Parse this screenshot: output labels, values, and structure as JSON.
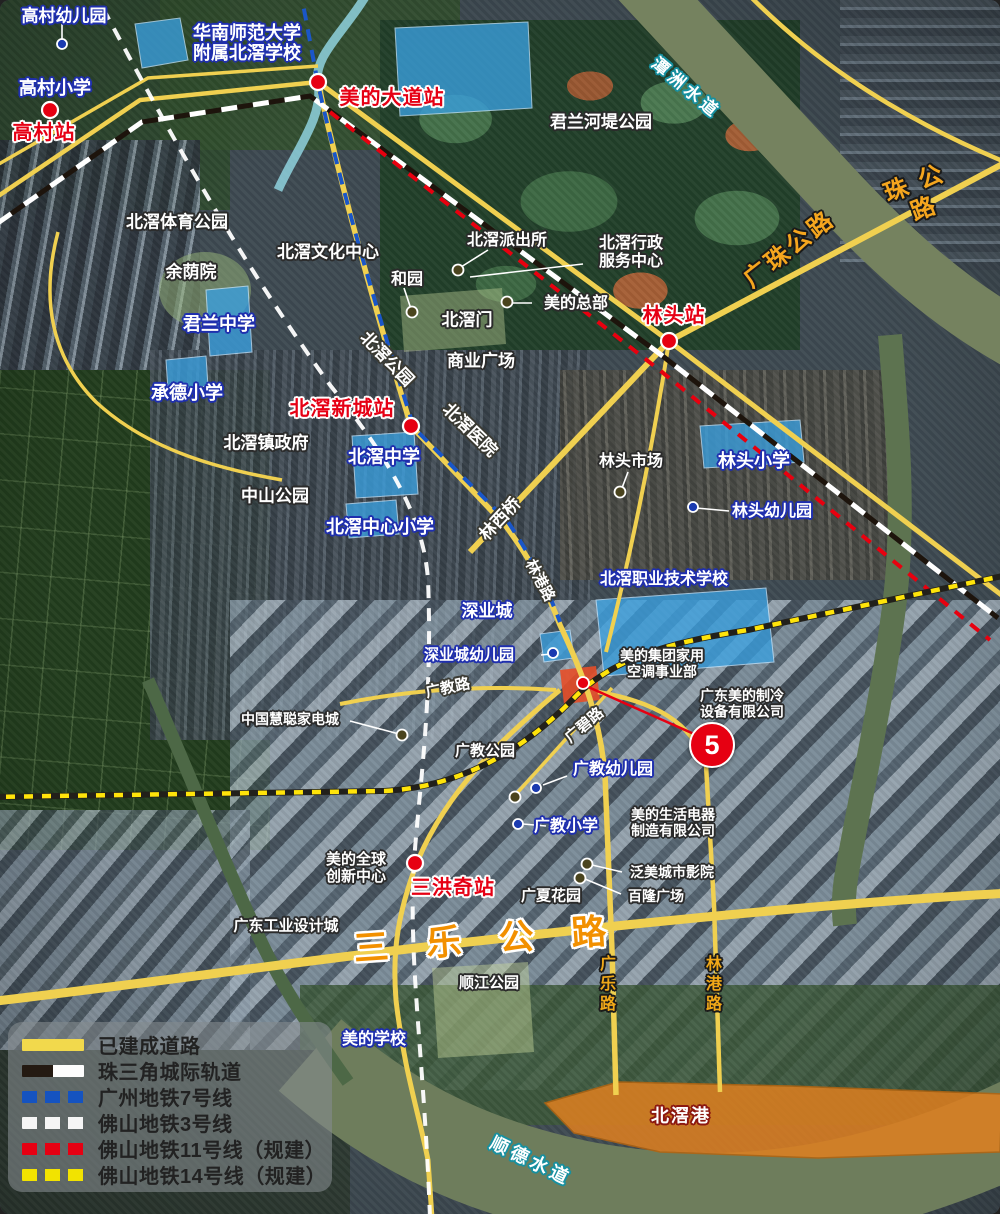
{
  "map": {
    "title": "北滘 卫星配套地图",
    "marker5": {
      "label": "5"
    },
    "colors": {
      "station_text": "#e60014",
      "school_outline": "#1f2fae",
      "road_yellow": "#f0d050",
      "highway_label": "#f29000",
      "metro7_blue": "#1553c0",
      "metro3_white": "#f5f5f5",
      "metro11_red": "#e60012",
      "metro14_yellow": "#f2e300",
      "port_fill": "#e08020",
      "school_fill": "#3aa0e0",
      "water_label_outline": "#1790a0"
    },
    "labels": [
      {
        "n": "label-gaocun-kindergarten",
        "t": "高村幼儿园",
        "c": "sc",
        "x": 64,
        "y": 16,
        "r": 0,
        "s": 17
      },
      {
        "n": "label-gaocun-primary",
        "t": "高村小学",
        "c": "sc",
        "x": 55,
        "y": 88,
        "r": 0,
        "s": 18
      },
      {
        "n": "label-scnu-beijiao-school",
        "t": "华南师范大学\n附属北滘学校",
        "c": "sc",
        "x": 247,
        "y": 43,
        "r": 0,
        "s": 18
      },
      {
        "n": "label-junlan-middle",
        "t": "君兰中学",
        "c": "sc",
        "x": 219,
        "y": 324,
        "r": 0,
        "s": 18
      },
      {
        "n": "label-chengde-primary",
        "t": "承德小学",
        "c": "sc",
        "x": 187,
        "y": 393,
        "r": 0,
        "s": 18
      },
      {
        "n": "label-beijiao-middle",
        "t": "北滘中学",
        "c": "sc",
        "x": 384,
        "y": 457,
        "r": 0,
        "s": 18
      },
      {
        "n": "label-beijiao-central-primary",
        "t": "北滘中心小学",
        "c": "sc",
        "x": 380,
        "y": 527,
        "r": 0,
        "s": 18
      },
      {
        "n": "label-lintou-primary",
        "t": "林头小学",
        "c": "sc",
        "x": 754,
        "y": 461,
        "r": 0,
        "s": 18
      },
      {
        "n": "label-lintou-kindergarten",
        "t": "林头幼儿园",
        "c": "sc",
        "x": 772,
        "y": 512,
        "r": 0,
        "s": 16
      },
      {
        "n": "label-beijiao-vocational",
        "t": "北滘职业技术学校",
        "c": "sc",
        "x": 664,
        "y": 580,
        "r": 0,
        "s": 16
      },
      {
        "n": "label-shenyecheng",
        "t": "深业城",
        "c": "sc",
        "x": 487,
        "y": 611,
        "r": 0,
        "s": 17
      },
      {
        "n": "label-shenyecheng-kindergarten",
        "t": "深业城幼儿园",
        "c": "sc",
        "x": 469,
        "y": 656,
        "r": 0,
        "s": 15
      },
      {
        "n": "label-guangjiao-kindergarten",
        "t": "广教幼儿园",
        "c": "sc",
        "x": 613,
        "y": 770,
        "r": 0,
        "s": 16
      },
      {
        "n": "label-guangjiao-primary",
        "t": "广教小学",
        "c": "sc",
        "x": 566,
        "y": 827,
        "r": 0,
        "s": 16
      },
      {
        "n": "label-midea-school",
        "t": "美的学校",
        "c": "sc",
        "x": 374,
        "y": 1040,
        "r": 0,
        "s": 16
      },
      {
        "n": "label-junlan-riverside-park",
        "t": "君兰河堤公园",
        "c": "pl",
        "x": 601,
        "y": 122,
        "r": 0,
        "s": 17
      },
      {
        "n": "label-beijiao-sports-park",
        "t": "北滘体育公园",
        "c": "pl",
        "x": 177,
        "y": 222,
        "r": 0,
        "s": 17
      },
      {
        "n": "label-yuyinyuan",
        "t": "余荫院",
        "c": "pl",
        "x": 191,
        "y": 272,
        "r": 0,
        "s": 17
      },
      {
        "n": "label-beijiao-culture-center",
        "t": "北滘文化中心",
        "c": "pl",
        "x": 328,
        "y": 252,
        "r": 0,
        "s": 17
      },
      {
        "n": "label-heyuan",
        "t": "和园",
        "c": "pl",
        "x": 407,
        "y": 280,
        "r": 0,
        "s": 16
      },
      {
        "n": "label-beijiao-police",
        "t": "北滘派出所",
        "c": "pl",
        "x": 507,
        "y": 241,
        "r": 0,
        "s": 16
      },
      {
        "n": "label-beijiao-admin-center",
        "t": "北滘行政\n服务中心",
        "c": "pl",
        "x": 631,
        "y": 253,
        "r": 0,
        "s": 16
      },
      {
        "n": "label-midea-hq",
        "t": "美的总部",
        "c": "pl",
        "x": 576,
        "y": 304,
        "r": 0,
        "s": 16
      },
      {
        "n": "label-beijiao-gate",
        "t": "北滘门",
        "c": "pl",
        "x": 467,
        "y": 320,
        "r": 0,
        "s": 17
      },
      {
        "n": "label-commercial-plaza",
        "t": "商业广场",
        "c": "pl",
        "x": 481,
        "y": 361,
        "r": 0,
        "s": 17
      },
      {
        "n": "label-beijiao-government",
        "t": "北滘镇政府",
        "c": "pl",
        "x": 266,
        "y": 443,
        "r": 0,
        "s": 17
      },
      {
        "n": "label-zhongshan-park",
        "t": "中山公园",
        "c": "pl",
        "x": 275,
        "y": 496,
        "r": 0,
        "s": 17
      },
      {
        "n": "label-lintou-market",
        "t": "林头市场",
        "c": "pl",
        "x": 631,
        "y": 462,
        "r": 0,
        "s": 16
      },
      {
        "n": "label-midea-hvac",
        "t": "美的集团家用\n空调事业部",
        "c": "pl",
        "x": 662,
        "y": 664,
        "r": 0,
        "s": 14
      },
      {
        "n": "label-gd-midea-refrigeration",
        "t": "广东美的制冷\n设备有限公司",
        "c": "pl",
        "x": 742,
        "y": 704,
        "r": 0,
        "s": 14
      },
      {
        "n": "label-hc360-mall",
        "t": "中国慧聪家电城",
        "c": "pl",
        "x": 290,
        "y": 720,
        "r": 0,
        "s": 14
      },
      {
        "n": "label-guangjiao-park",
        "t": "广教公园",
        "c": "pl",
        "x": 485,
        "y": 752,
        "r": 0,
        "s": 15
      },
      {
        "n": "label-midea-life-appliance",
        "t": "美的生活电器\n制造有限公司",
        "c": "pl",
        "x": 673,
        "y": 823,
        "r": 0,
        "s": 14
      },
      {
        "n": "label-panmei-cinema",
        "t": "泛美城市影院",
        "c": "pl",
        "x": 672,
        "y": 873,
        "r": 0,
        "s": 14
      },
      {
        "n": "label-bailong-plaza",
        "t": "百隆广场",
        "c": "pl",
        "x": 656,
        "y": 897,
        "r": 0,
        "s": 14
      },
      {
        "n": "label-guangxia-garden",
        "t": "广夏花园",
        "c": "pl",
        "x": 551,
        "y": 897,
        "r": 0,
        "s": 15
      },
      {
        "n": "label-midea-innovation-center",
        "t": "美的全球\n创新中心",
        "c": "pl",
        "x": 356,
        "y": 869,
        "r": 0,
        "s": 15
      },
      {
        "n": "label-gd-industrial-design-city",
        "t": "广东工业设计城",
        "c": "pl",
        "x": 286,
        "y": 927,
        "r": 0,
        "s": 15
      },
      {
        "n": "label-shunjiang-park",
        "t": "顺江公园",
        "c": "pl",
        "x": 489,
        "y": 984,
        "r": 0,
        "s": 15
      },
      {
        "n": "label-gaocun-station",
        "t": "高村站",
        "c": "st",
        "x": 44,
        "y": 133,
        "r": 0,
        "s": 20
      },
      {
        "n": "label-meide-avenue-station",
        "t": "美的大道站",
        "c": "st",
        "x": 392,
        "y": 98,
        "r": 0,
        "s": 20
      },
      {
        "n": "label-lintou-station",
        "t": "林头站",
        "c": "st",
        "x": 674,
        "y": 316,
        "r": 0,
        "s": 20
      },
      {
        "n": "label-beijiao-xincheng-station",
        "t": "北滘新城站",
        "c": "st",
        "x": 342,
        "y": 409,
        "r": 0,
        "s": 20
      },
      {
        "n": "label-sanhongqi-station",
        "t": "三洪奇站",
        "c": "st",
        "x": 453,
        "y": 888,
        "r": 0,
        "s": 20
      },
      {
        "n": "label-guangzhu-highway",
        "t": "广珠公路",
        "c": "ro",
        "x": 790,
        "y": 250,
        "r": -38,
        "s": 24
      },
      {
        "n": "label-guangzhu-highway-2",
        "t": "珠 公 路",
        "c": "ro",
        "x": 920,
        "y": 197,
        "r": -21,
        "s": 24
      },
      {
        "n": "label-sanle-highway",
        "t": "三 乐 公 路",
        "c": "rb",
        "x": 487,
        "y": 940,
        "r": -4,
        "s": 35
      },
      {
        "n": "label-beijiao-park-road",
        "t": "北滘公园",
        "c": "rw",
        "x": 387,
        "y": 359,
        "r": 46,
        "s": 17
      },
      {
        "n": "label-beijiao-hospital",
        "t": "北滘医院",
        "c": "rw",
        "x": 470,
        "y": 430,
        "r": 44,
        "s": 17
      },
      {
        "n": "label-linxi-bridge",
        "t": "林西桥",
        "c": "rw",
        "x": 500,
        "y": 519,
        "r": -47,
        "s": 17
      },
      {
        "n": "label-lingang-road-mid",
        "t": "林港路",
        "c": "rw",
        "x": 539,
        "y": 581,
        "r": 62,
        "s": 15
      },
      {
        "n": "label-guangjiao-road",
        "t": "广教路",
        "c": "rw",
        "x": 448,
        "y": 689,
        "r": -12,
        "s": 15
      },
      {
        "n": "label-guangbi-road",
        "t": "广碧路",
        "c": "rw",
        "x": 585,
        "y": 726,
        "r": -40,
        "s": 15
      },
      {
        "n": "label-guangle-road",
        "t": "广乐路",
        "c": "rv",
        "x": 605,
        "y": 985,
        "r": 0,
        "s": 16
      },
      {
        "n": "label-lingang-road-south",
        "t": "林港路",
        "c": "rv",
        "x": 711,
        "y": 985,
        "r": 0,
        "s": 16
      },
      {
        "n": "label-tanzhou-waterway",
        "t": "潭洲水道",
        "c": "wa",
        "x": 686,
        "y": 88,
        "r": 40,
        "s": 17
      },
      {
        "n": "label-shunde-waterway",
        "t": "顺德水道",
        "c": "wa",
        "x": 531,
        "y": 1161,
        "r": 26,
        "s": 18
      },
      {
        "n": "label-beijiao-port",
        "t": "北滘港",
        "c": "po",
        "x": 681,
        "y": 1116,
        "r": 0,
        "s": 18
      }
    ],
    "dots": [
      {
        "k": "red",
        "x": 50,
        "y": 110
      },
      {
        "k": "red",
        "x": 318,
        "y": 82
      },
      {
        "k": "red",
        "x": 669,
        "y": 341
      },
      {
        "k": "red",
        "x": 411,
        "y": 426
      },
      {
        "k": "red",
        "x": 415,
        "y": 863
      },
      {
        "k": "blue",
        "x": 62,
        "y": 44
      },
      {
        "k": "blue",
        "x": 693,
        "y": 507
      },
      {
        "k": "blue",
        "x": 553,
        "y": 653
      },
      {
        "k": "blue",
        "x": 536,
        "y": 788
      },
      {
        "k": "blue",
        "x": 518,
        "y": 824
      },
      {
        "k": "dark",
        "x": 412,
        "y": 312
      },
      {
        "k": "dark",
        "x": 458,
        "y": 270
      },
      {
        "k": "dark",
        "x": 507,
        "y": 302
      },
      {
        "k": "dark",
        "x": 620,
        "y": 492
      },
      {
        "k": "dark",
        "x": 402,
        "y": 735
      },
      {
        "k": "dark",
        "x": 515,
        "y": 797
      },
      {
        "k": "dark",
        "x": 587,
        "y": 864
      },
      {
        "k": "dark",
        "x": 580,
        "y": 878
      },
      {
        "k": "redsm",
        "x": 583,
        "y": 683
      }
    ],
    "leaders": [
      {
        "k": "w",
        "x1": 62,
        "y1": 24,
        "x2": 62,
        "y2": 40
      },
      {
        "k": "w",
        "x1": 488,
        "y1": 250,
        "x2": 461,
        "y2": 267
      },
      {
        "k": "w",
        "x1": 583,
        "y1": 264,
        "x2": 470,
        "y2": 277
      },
      {
        "k": "w",
        "x1": 532,
        "y1": 303,
        "x2": 513,
        "y2": 303
      },
      {
        "k": "w",
        "x1": 404,
        "y1": 288,
        "x2": 411,
        "y2": 309
      },
      {
        "k": "w",
        "x1": 696,
        "y1": 508,
        "x2": 729,
        "y2": 511
      },
      {
        "k": "w",
        "x1": 541,
        "y1": 655,
        "x2": 551,
        "y2": 654
      },
      {
        "k": "w",
        "x1": 350,
        "y1": 721,
        "x2": 399,
        "y2": 734
      },
      {
        "k": "w",
        "x1": 543,
        "y1": 785,
        "x2": 567,
        "y2": 776
      },
      {
        "k": "w",
        "x1": 523,
        "y1": 824,
        "x2": 546,
        "y2": 826
      },
      {
        "k": "w",
        "x1": 592,
        "y1": 865,
        "x2": 622,
        "y2": 872
      },
      {
        "k": "w",
        "x1": 585,
        "y1": 879,
        "x2": 621,
        "y2": 894
      },
      {
        "k": "w",
        "x1": 628,
        "y1": 472,
        "x2": 622,
        "y2": 488
      },
      {
        "k": "r",
        "x1": 586,
        "y1": 686,
        "x2": 703,
        "y2": 738
      }
    ],
    "legend": {
      "items": [
        {
          "kind": "sw-solid",
          "label": "已建成道路"
        },
        {
          "kind": "sw-bw",
          "label": "珠三角城际轨道"
        },
        {
          "kind": "sw-blue",
          "label": "广州地铁7号线"
        },
        {
          "kind": "sw-white",
          "label": "佛山地铁3号线"
        },
        {
          "kind": "sw-red",
          "label": "佛山地铁11号线（规建）"
        },
        {
          "kind": "sw-yellow",
          "label": "佛山地铁14号线（规建）"
        }
      ]
    }
  }
}
